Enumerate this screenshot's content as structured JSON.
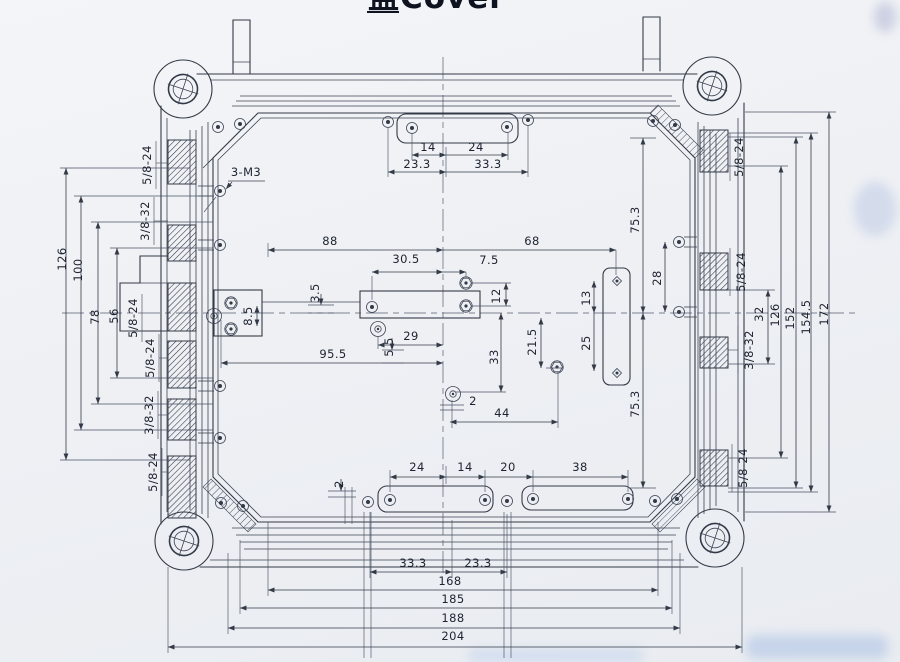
{
  "colors": {
    "ink": "#333a47",
    "paper": "#f0f2f6"
  },
  "title": {
    "text": "盖Cover"
  },
  "annotations": {
    "thread_callout": "3-M3"
  },
  "thread_labels": {
    "left": [
      "5/8-24",
      "3/8-32",
      "5/8-24",
      "5/8-24",
      "3/8-32",
      "5/8-24"
    ],
    "right": [
      "5/8-24",
      "5/8-24",
      "3/8-32",
      "5/8-24"
    ]
  },
  "dimensions": {
    "top_boss": {
      "w_left": "14",
      "w_right": "24",
      "off_left": "23.3",
      "off_right": "33.3"
    },
    "center": {
      "span_left": "88",
      "span_right": "68",
      "d305": "30.5",
      "d75": "7.5",
      "d12": "12",
      "d35": "3.5",
      "d85": "8.5",
      "d55": "5.5",
      "d29": "29",
      "d955": "95.5",
      "d33": "33",
      "d215": "21.5",
      "d13": "13",
      "d25": "25",
      "d28": "28",
      "d2": "2",
      "d44": "44"
    },
    "bottom_boss": {
      "d2": "2",
      "d24": "24",
      "d14": "14",
      "d20": "20",
      "d38": "38",
      "d333": "33.3",
      "d233": "23.3"
    },
    "overall": {
      "d168": "168",
      "d185": "185",
      "d188": "188",
      "d204": "204"
    },
    "left_vertical": {
      "d126": "126",
      "d100": "100",
      "d78": "78",
      "d56": "56"
    },
    "right_vertical": {
      "d753_upper": "75.3",
      "d753_lower": "75.3",
      "d32": "32",
      "d126": "126",
      "d152": "152",
      "d1545": "154.5",
      "d172": "172"
    }
  }
}
